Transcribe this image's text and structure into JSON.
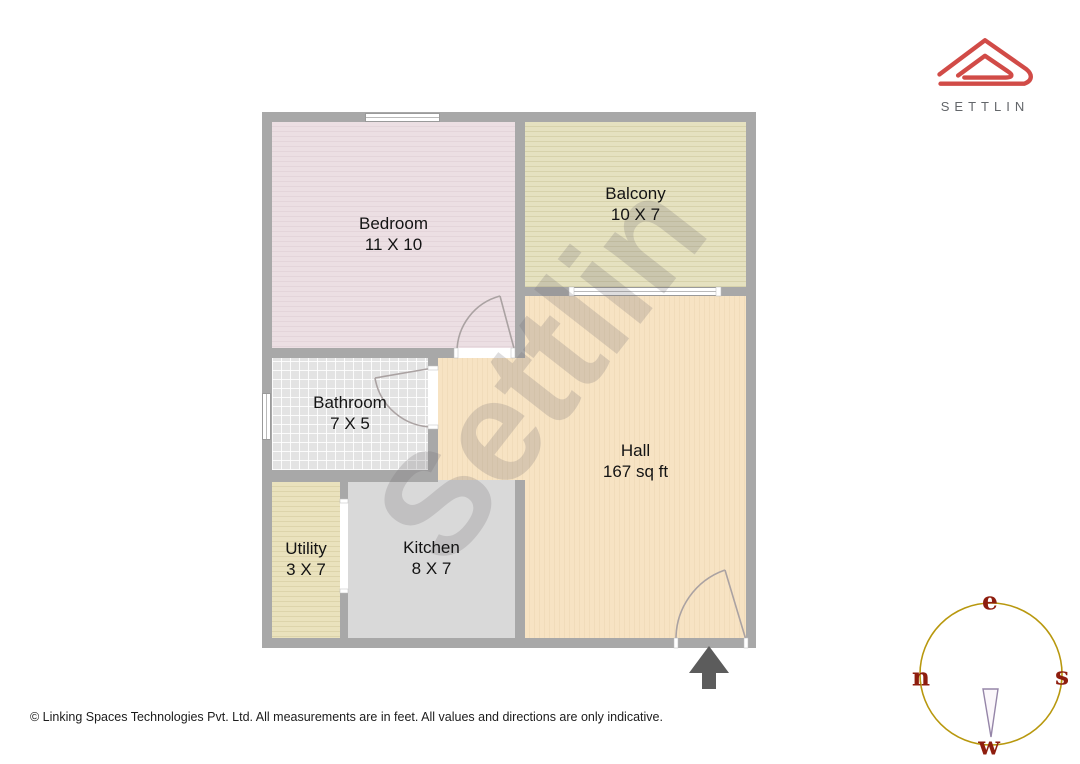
{
  "brand": {
    "name": "SETTLIN"
  },
  "watermark_text": "Settlin",
  "rooms": [
    {
      "name": "Bedroom",
      "size": "11 X 10"
    },
    {
      "name": "Balcony",
      "size": "10 X 7"
    },
    {
      "name": "Hall",
      "size": "167 sq ft"
    },
    {
      "name": "Bathroom",
      "size": "7 X 5"
    },
    {
      "name": "Utility",
      "size": "3 X 7"
    },
    {
      "name": "Kitchen",
      "size": "8 X 7"
    }
  ],
  "compass": {
    "top": "e",
    "left": "n",
    "right": "s",
    "bottom": "w"
  },
  "footer_text": "© Linking Spaces Technologies Pvt. Ltd. All measurements are in feet. All values and directions are only indicative.",
  "colors": {
    "wall": "#a8a8a8",
    "bedroom_fill": "#ecdfe3",
    "balcony_fill": "#e5e1c0",
    "hall_fill": "#f7e3c3",
    "bathroom_fill": "#e3e3e3",
    "utility_fill": "#eae2bd",
    "kitchen_fill": "#d9d9d9",
    "logo_red": "#d14b47",
    "compass_ring": "#b8980e",
    "compass_letters": "#8e1d0e",
    "entrance_arrow": "#5c5c5c"
  }
}
